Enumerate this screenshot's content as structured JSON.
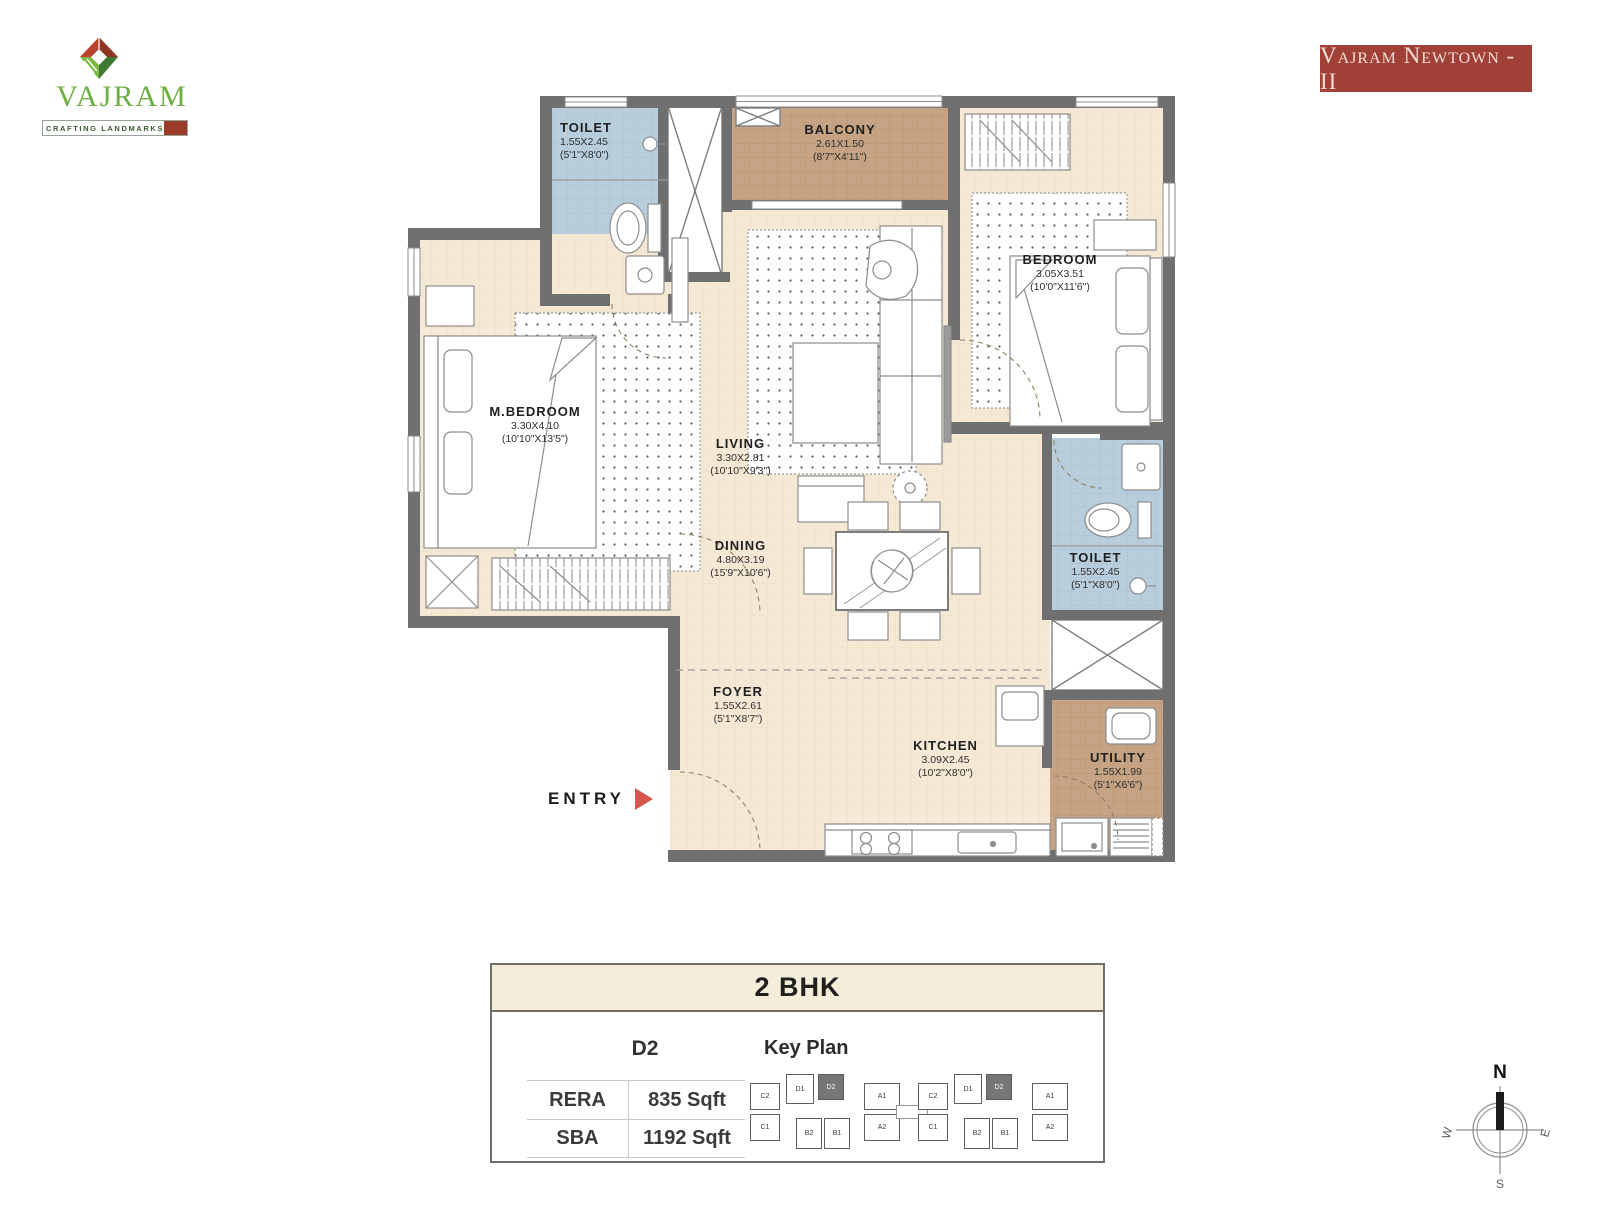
{
  "brand": {
    "name": "VAJRAM",
    "tagline": "CRAFTING LANDMARKS",
    "banner": "Vajram Newtown - II"
  },
  "plan": {
    "entry": "ENTRY",
    "rooms": [
      {
        "id": "toilet-1",
        "name": "TOILET",
        "m": "1.55X2.45",
        "ft": "(5'1\"X8'0\")"
      },
      {
        "id": "balcony",
        "name": "BALCONY",
        "m": "2.61X1.50",
        "ft": "(8'7\"X4'11\")"
      },
      {
        "id": "bedroom",
        "name": "BEDROOM",
        "m": "3.05X3.51",
        "ft": "(10'0\"X11'6\")"
      },
      {
        "id": "m-bedroom",
        "name": "M.BEDROOM",
        "m": "3.30X4.10",
        "ft": "(10'10\"X13'5\")"
      },
      {
        "id": "living",
        "name": "LIVING",
        "m": "3.30X2.81",
        "ft": "(10'10\"X9'3\")"
      },
      {
        "id": "dining",
        "name": "DINING",
        "m": "4.80X3.19",
        "ft": "(15'9\"X10'6\")"
      },
      {
        "id": "toilet-2",
        "name": "TOILET",
        "m": "1.55X2.45",
        "ft": "(5'1\"X8'0\")"
      },
      {
        "id": "foyer",
        "name": "FOYER",
        "m": "1.55X2.61",
        "ft": "(5'1\"X8'7\")"
      },
      {
        "id": "kitchen",
        "name": "KITCHEN",
        "m": "3.09X2.45",
        "ft": "(10'2\"X8'0\")"
      },
      {
        "id": "utility",
        "name": "UTILITY",
        "m": "1.55X1.99",
        "ft": "(5'1\"X6'6\")"
      }
    ]
  },
  "info": {
    "type": "2 BHK",
    "unit": "D2",
    "keyplan_title": "Key Plan",
    "rows": [
      {
        "label": "RERA",
        "value": "835 Sqft"
      },
      {
        "label": "SBA",
        "value": "1192 Sqft"
      }
    ]
  },
  "keyplan": {
    "highlighted_unit": "D2",
    "wings": [
      {
        "units": [
          "C2",
          "C1",
          "D1",
          "D2",
          "A1",
          "A2",
          "B2",
          "B1"
        ]
      },
      {
        "units": [
          "C2",
          "C1",
          "D1",
          "D2",
          "A1",
          "A2",
          "B2",
          "B1"
        ]
      }
    ]
  },
  "compass": {
    "north": "N",
    "south": "S",
    "east": "E",
    "west": "W"
  },
  "colors": {
    "wall": "#6f6f6f",
    "floor_cream": "#f5e9d6",
    "floor_toilet": "#b9cedd",
    "floor_balcony": "#c5a384",
    "banner_bg": "#a14036",
    "entry_arrow": "#d5564f",
    "logo_green": "#6fae43",
    "logo_red": "#9c3b2b"
  }
}
